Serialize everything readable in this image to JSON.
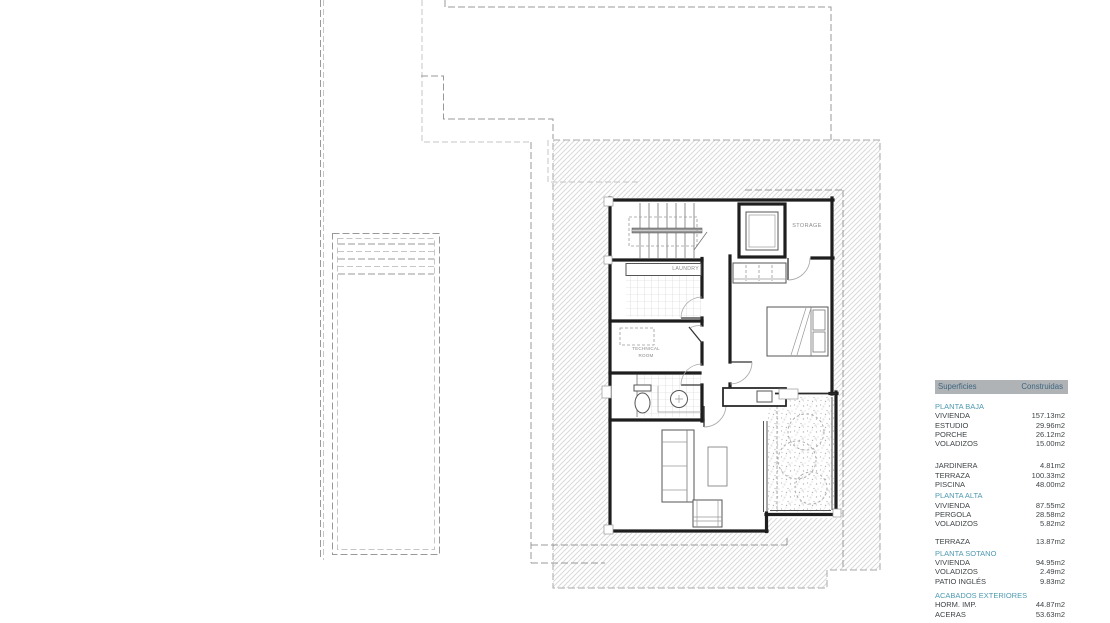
{
  "plan": {
    "labels": {
      "storage": "STORAGE",
      "laundry": "LAUNDRY",
      "technical_line1": "TECHNICAL",
      "technical_line2": "ROOM"
    }
  },
  "table": {
    "header": {
      "col_left": "Superficies",
      "col_right": "Construidas"
    },
    "groups": [
      {
        "title": "PLANTA BAJA",
        "rows": [
          {
            "label": "VIVIENDA",
            "value": "157.13m2"
          },
          {
            "label": "ESTUDIO",
            "value": "29.96m2"
          },
          {
            "label": "PORCHE",
            "value": "26.12m2"
          },
          {
            "label": "VOLADIZOS",
            "value": "15.00m2"
          }
        ]
      },
      {
        "title": "",
        "rows": [
          {
            "label": "JARDINERA",
            "value": "4.81m2"
          },
          {
            "label": "TERRAZA",
            "value": "100.33m2"
          },
          {
            "label": "PISCINA",
            "value": "48.00m2"
          }
        ]
      },
      {
        "title": "PLANTA ALTA",
        "rows": [
          {
            "label": "VIVIENDA",
            "value": "87.55m2"
          },
          {
            "label": "PERGOLA",
            "value": "28.58m2"
          },
          {
            "label": "VOLADIZOS",
            "value": "5.82m2"
          }
        ]
      },
      {
        "title": "",
        "rows": [
          {
            "label": "TERRAZA",
            "value": "13.87m2"
          }
        ]
      },
      {
        "title": "PLANTA SOTANO",
        "rows": [
          {
            "label": "VIVIENDA",
            "value": "94.95m2"
          },
          {
            "label": "VOLADIZOS",
            "value": "2.49m2"
          },
          {
            "label": "PATIO INGLÉS",
            "value": "9.83m2"
          }
        ]
      },
      {
        "title": "ACABADOS EXTERIORES",
        "rows": [
          {
            "label": "HORM. IMP.",
            "value": "44.87m2"
          },
          {
            "label": "ACERAS",
            "value": "53.63m2"
          }
        ]
      }
    ]
  },
  "colors": {
    "accent_teal": "#4e9ab2",
    "header_bg": "#b0b3b6",
    "header_text": "#3d6680",
    "body_text": "#3f4447"
  }
}
